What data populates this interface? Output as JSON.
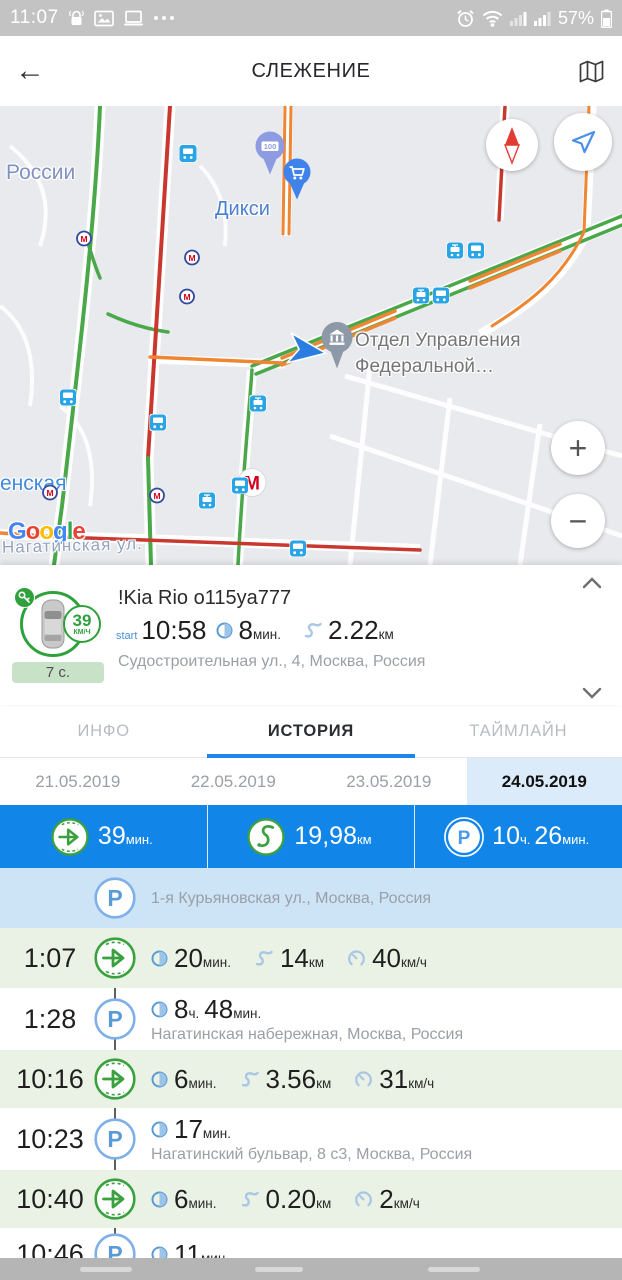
{
  "status_bar": {
    "time": "11:07",
    "battery": "57%"
  },
  "app_bar": {
    "title": "СЛЕЖЕНИЕ"
  },
  "map": {
    "labels": {
      "region": "России",
      "metro_station": "енская",
      "store": "Дикси",
      "poi_line1": "Отдел Управления",
      "poi_line2": "Федеральной…",
      "street": "Нагатинская ул.",
      "attribution": "Google",
      "pin_100": "100",
      "metro_letter": "М"
    },
    "controls": {
      "zoom_in": "+",
      "zoom_out": "−"
    },
    "markers": [
      {
        "type": "bus-stop",
        "x": 188,
        "y": 50
      },
      {
        "type": "pin-100",
        "x": 270,
        "y": 50
      },
      {
        "type": "metro-small",
        "x": 84,
        "y": 135
      },
      {
        "type": "metro-small",
        "x": 192,
        "y": 154
      },
      {
        "type": "metro-small",
        "x": 187,
        "y": 193
      },
      {
        "type": "metro-small",
        "x": 50,
        "y": 389
      },
      {
        "type": "metro-small",
        "x": 157,
        "y": 392
      },
      {
        "type": "metro-large",
        "x": 252,
        "y": 379
      },
      {
        "type": "cart-pin",
        "x": 297,
        "y": 76
      },
      {
        "type": "tram",
        "x": 455,
        "y": 147
      },
      {
        "type": "bus",
        "x": 476,
        "y": 147
      },
      {
        "type": "tram",
        "x": 421,
        "y": 192
      },
      {
        "type": "bus",
        "x": 441,
        "y": 192
      },
      {
        "type": "bus",
        "x": 68,
        "y": 294
      },
      {
        "type": "bus",
        "x": 158,
        "y": 319
      },
      {
        "type": "tram",
        "x": 258,
        "y": 300
      },
      {
        "type": "bus",
        "x": 240,
        "y": 382
      },
      {
        "type": "tram",
        "x": 207,
        "y": 397
      },
      {
        "type": "bus",
        "x": 298,
        "y": 445
      },
      {
        "type": "vehicle-arrow",
        "x": 307,
        "y": 247
      },
      {
        "type": "poi-pin",
        "x": 337,
        "y": 242
      }
    ]
  },
  "vehicle_card": {
    "name": "!Kia Rio o115ya777",
    "speed_value": "39",
    "speed_unit": "км/ч",
    "status_badge": "7 с.",
    "start_label": "start",
    "start_time": "10:58",
    "duration_value": "8",
    "duration_unit": "мин.",
    "distance_value": "2.22",
    "distance_unit": "км",
    "address": "Судостроительная ул., 4, Москва, Россия"
  },
  "tabs": [
    {
      "label": "ИНФО",
      "active": false
    },
    {
      "label": "ИСТОРИЯ",
      "active": true
    },
    {
      "label": "ТАЙМЛАЙН",
      "active": false
    }
  ],
  "dates": [
    {
      "label": "21.05.2019",
      "active": false
    },
    {
      "label": "22.05.2019",
      "active": false
    },
    {
      "label": "23.05.2019",
      "active": false
    },
    {
      "label": "24.05.2019",
      "active": true
    }
  ],
  "summary": [
    {
      "icon": "trip",
      "parts": [
        {
          "v": "39",
          "u": "мин."
        }
      ]
    },
    {
      "icon": "route",
      "parts": [
        {
          "v": "19,98",
          "u": "км"
        }
      ]
    },
    {
      "icon": "parking",
      "parts": [
        {
          "v": "10",
          "u": "ч."
        },
        {
          "v": "26",
          "u": "мин."
        }
      ]
    }
  ],
  "timeline": [
    {
      "type": "parking",
      "time": "",
      "bg": "blue",
      "stats": [],
      "address": "1-я Курьяновская ул., Москва, Россия"
    },
    {
      "type": "trip",
      "time": "1:07",
      "bg": "green",
      "stats": [
        {
          "icon": "duration",
          "parts": [
            {
              "v": "20",
              "u": "мин."
            }
          ]
        },
        {
          "icon": "distance",
          "parts": [
            {
              "v": "14",
              "u": "км"
            }
          ]
        },
        {
          "icon": "speed",
          "parts": [
            {
              "v": "40",
              "u": "км/ч"
            }
          ]
        }
      ]
    },
    {
      "type": "parking",
      "time": "1:28",
      "bg": "white",
      "stats": [
        {
          "icon": "duration",
          "parts": [
            {
              "v": "8",
              "u": "ч."
            },
            {
              "v": "48",
              "u": "мин."
            }
          ]
        }
      ],
      "address": "Нагатинская набережная, Москва, Россия"
    },
    {
      "type": "trip",
      "time": "10:16",
      "bg": "green",
      "stats": [
        {
          "icon": "duration",
          "parts": [
            {
              "v": "6",
              "u": "мин."
            }
          ]
        },
        {
          "icon": "distance",
          "parts": [
            {
              "v": "3.56",
              "u": "км"
            }
          ]
        },
        {
          "icon": "speed",
          "parts": [
            {
              "v": "31",
              "u": "км/ч"
            }
          ]
        }
      ]
    },
    {
      "type": "parking",
      "time": "10:23",
      "bg": "white",
      "stats": [
        {
          "icon": "duration",
          "parts": [
            {
              "v": "17",
              "u": "мин."
            }
          ]
        }
      ],
      "address": "Нагатинский бульвар, 8 с3, Москва, Россия"
    },
    {
      "type": "trip",
      "time": "10:40",
      "bg": "green",
      "stats": [
        {
          "icon": "duration",
          "parts": [
            {
              "v": "6",
              "u": "мин."
            }
          ]
        },
        {
          "icon": "distance",
          "parts": [
            {
              "v": "0.20",
              "u": "км"
            }
          ]
        },
        {
          "icon": "speed",
          "parts": [
            {
              "v": "2",
              "u": "км/ч"
            }
          ]
        }
      ]
    },
    {
      "type": "parking",
      "time": "10:46",
      "bg": "white",
      "stats": [
        {
          "icon": "duration",
          "parts": [
            {
              "v": "11",
              "u": "мин."
            }
          ]
        }
      ],
      "address": ""
    }
  ]
}
